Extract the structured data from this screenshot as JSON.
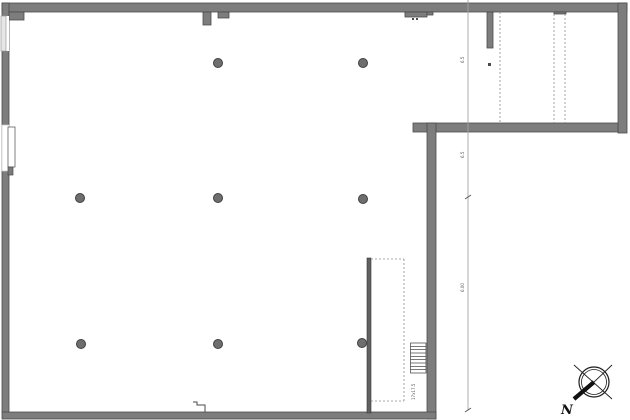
{
  "canvas": {
    "w": 630,
    "h": 420,
    "bg": "#ffffff"
  },
  "colors": {
    "wall_fill": "#7d7d7d",
    "wall_edge": "#4c4c4c",
    "thin_wall": "#616161",
    "dashed_line": "#8c8c8c",
    "dimension_line": "#a3a3a3",
    "column_fill": "#6e6e6e",
    "compass_ink": "#1c1c1c",
    "background": "#ffffff"
  },
  "walls": [
    {
      "name": "top-wall",
      "x": 2,
      "y": 3,
      "w": 625,
      "h": 9
    },
    {
      "name": "left-wall",
      "x": 2,
      "y": 3,
      "w": 7,
      "h": 410
    },
    {
      "name": "top-left-corner-step",
      "x": 9,
      "y": 12,
      "w": 15,
      "h": 8
    },
    {
      "name": "top-wall-pier-a",
      "x": 203,
      "y": 12,
      "w": 8,
      "h": 13
    },
    {
      "name": "top-wall-pier-b",
      "x": 218,
      "y": 12,
      "w": 11,
      "h": 6
    },
    {
      "name": "top-wall-protrusion",
      "x": 405,
      "y": 12,
      "w": 28,
      "h": 3
    },
    {
      "name": "top-wall-protrusion-deep",
      "x": 405,
      "y": 12,
      "w": 22,
      "h": 5
    },
    {
      "name": "top-wall-pier-right",
      "x": 554,
      "y": 12,
      "w": 12,
      "h": 2
    },
    {
      "name": "right-wall",
      "x": 618,
      "y": 3,
      "w": 9,
      "h": 130
    },
    {
      "name": "mid-horizontal-wall",
      "x": 413,
      "y": 123,
      "w": 205,
      "h": 9
    },
    {
      "name": "center-vertical-wall",
      "x": 427,
      "y": 123,
      "w": 9,
      "h": 296
    },
    {
      "name": "bottom-wall",
      "x": 2,
      "y": 412,
      "w": 434,
      "h": 7
    },
    {
      "name": "stub-wall-top-right",
      "x": 487,
      "y": 12,
      "w": 6,
      "h": 36
    }
  ],
  "thin_walls": [
    {
      "name": "stairwell-thin-wall",
      "x": 367,
      "y": 258,
      "w": 4,
      "h": 155
    }
  ],
  "openings": [
    {
      "name": "window-gap-top-left",
      "x": 1,
      "y": 16,
      "w": 8,
      "h": 35,
      "fill": "#ffffff",
      "stroke": "none"
    },
    {
      "name": "window-frame-top-left",
      "x": 1,
      "y": 16,
      "w": 5,
      "h": 35,
      "fill": "#e6e6e6",
      "stroke": "#9a9a9a"
    },
    {
      "name": "door-gap-left",
      "x": 2,
      "y": 125,
      "w": 7,
      "h": 46,
      "fill": "#ffffff",
      "stroke": "#c9c9c9"
    },
    {
      "name": "door-leaf-left",
      "x": 8,
      "y": 127,
      "w": 7,
      "h": 40,
      "fill": "#ffffff",
      "stroke": "#4a4a4a"
    },
    {
      "name": "door-block-left",
      "x": 8,
      "y": 167,
      "w": 5,
      "h": 8,
      "fill": "#7a7a7a",
      "stroke": "#4c4c4c"
    }
  ],
  "columns": {
    "radius": 4.5,
    "points": [
      [
        218,
        63
      ],
      [
        363,
        63
      ],
      [
        80,
        198
      ],
      [
        218,
        198
      ],
      [
        363,
        199
      ],
      [
        81,
        344
      ],
      [
        218,
        344
      ],
      [
        362,
        343
      ]
    ]
  },
  "small_marks": [
    {
      "x": 488,
      "y": 63,
      "w": 3,
      "h": 3
    },
    {
      "x": 412,
      "y": 18,
      "w": 2,
      "h": 2
    },
    {
      "x": 416,
      "y": 18,
      "w": 2,
      "h": 2
    }
  ],
  "dashed_lines": [
    [
      500,
      12,
      500,
      123
    ],
    [
      554,
      14,
      554,
      123
    ],
    [
      565,
      14,
      565,
      123
    ],
    [
      404,
      259,
      404,
      401
    ],
    [
      371,
      259,
      404,
      259
    ],
    [
      371,
      401,
      404,
      401
    ]
  ],
  "dimension_line": {
    "x": 468,
    "y1": 0,
    "y2": 410,
    "ticks": [
      197,
      410
    ],
    "labels": [
      {
        "t": "6.5",
        "x": 464,
        "y": 63
      },
      {
        "t": "6.5",
        "x": 464,
        "y": 158
      },
      {
        "t": "6.00",
        "x": 464,
        "y": 292
      }
    ]
  },
  "stair": {
    "x": 410.5,
    "y": 343,
    "w": 15.5,
    "h": 30,
    "treads": 9,
    "label": "17x17.5",
    "label_x": 415,
    "label_y": 400
  },
  "threshold": {
    "points": "193,402 197,402 197,405 205,405 205,412"
  },
  "compass": {
    "cx": 594,
    "cy": 382,
    "r_outer": 15,
    "r_inner": 12.5,
    "diag1": [
      574,
      365,
      612,
      399
    ],
    "diag2": [
      612,
      365,
      575,
      400
    ],
    "needle": [
      594,
      382,
      574,
      399
    ],
    "label": "N",
    "label_x": 561,
    "label_y": 414
  }
}
